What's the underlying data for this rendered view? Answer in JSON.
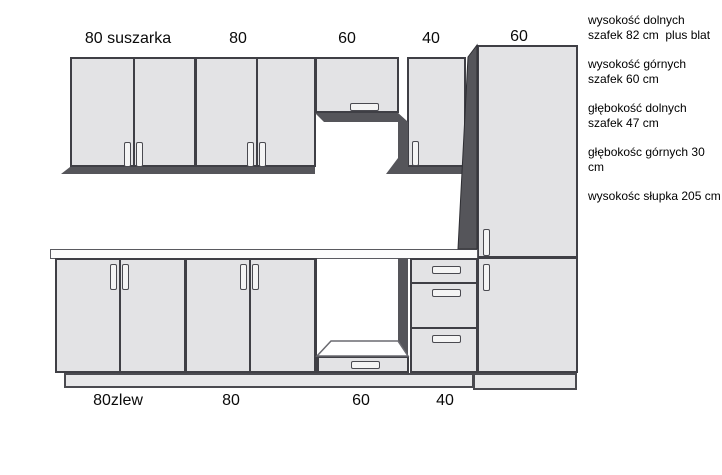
{
  "diagram": {
    "upper_row": {
      "labels": [
        "80 suszarka",
        "80",
        "60",
        "40",
        "60"
      ]
    },
    "lower_row": {
      "labels": [
        "80zlew",
        "80",
        "60",
        "40"
      ]
    },
    "annotations": [
      "wysokość dolnych\nszafek 82 cm  plus blat",
      "wysokość górnych\nszafek 60 cm",
      "głębokość dolnych\nszafek 47 cm",
      "głębokośc górnych 30\ncm",
      "wysokośc słupka 205 cm"
    ],
    "colors": {
      "cabinet_face": "#e3e3e5",
      "cabinet_side_shadow": "#55555a",
      "outline": "#3f3f45",
      "countertop": "#fcfcfc",
      "background": "#ffffff",
      "text": "#000000"
    }
  }
}
